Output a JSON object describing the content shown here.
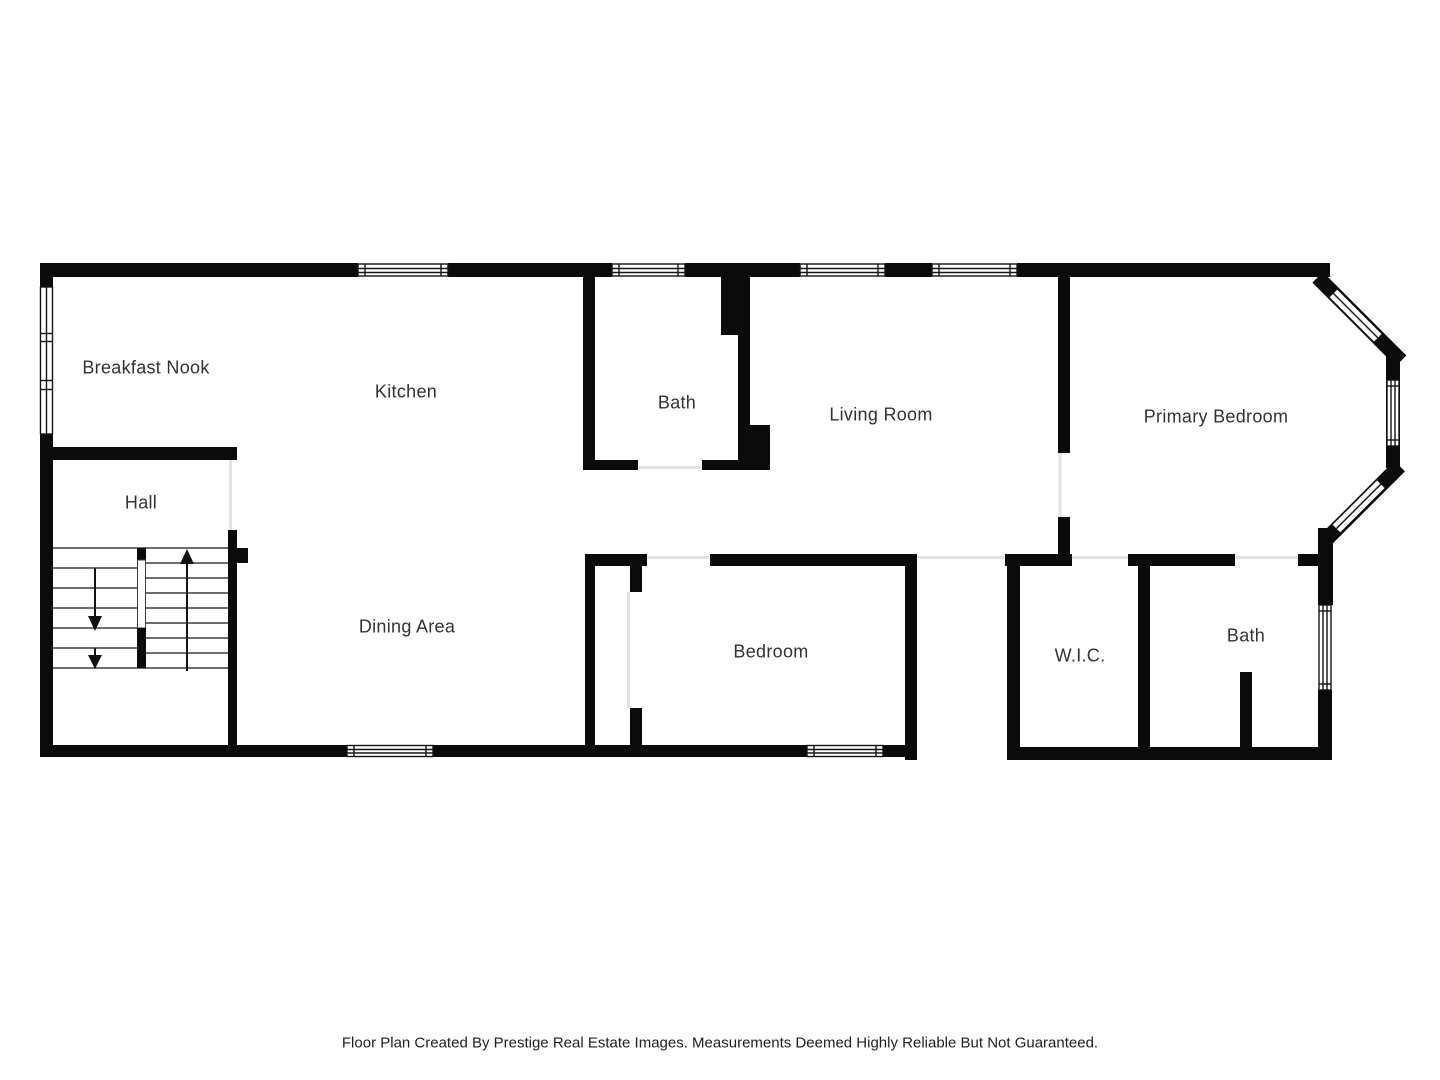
{
  "title": "Floor Plan",
  "rooms": [
    {
      "id": "breakfast-nook",
      "label": "Breakfast Nook"
    },
    {
      "id": "kitchen",
      "label": "Kitchen"
    },
    {
      "id": "bath-upper",
      "label": "Bath"
    },
    {
      "id": "living-room",
      "label": "Living Room"
    },
    {
      "id": "primary-bedroom",
      "label": "Primary Bedroom"
    },
    {
      "id": "hall",
      "label": "Hall"
    },
    {
      "id": "dining-area",
      "label": "Dining Area"
    },
    {
      "id": "bedroom",
      "label": "Bedroom"
    },
    {
      "id": "wic",
      "label": "W.I.C."
    },
    {
      "id": "bath-lower",
      "label": "Bath"
    }
  ],
  "stairs": {
    "direction_up_arrows": 1,
    "direction_down_arrows": 2
  },
  "colors": {
    "wall": "#0b0b0b",
    "label_text": "#333333",
    "stair_line": "#3f3f3f",
    "door_line": "#e3e3e3",
    "background": "#ffffff"
  },
  "footer": {
    "text": "Floor Plan Created By Prestige Real Estate Images. Measurements Deemed Highly Reliable But Not Guaranteed."
  }
}
